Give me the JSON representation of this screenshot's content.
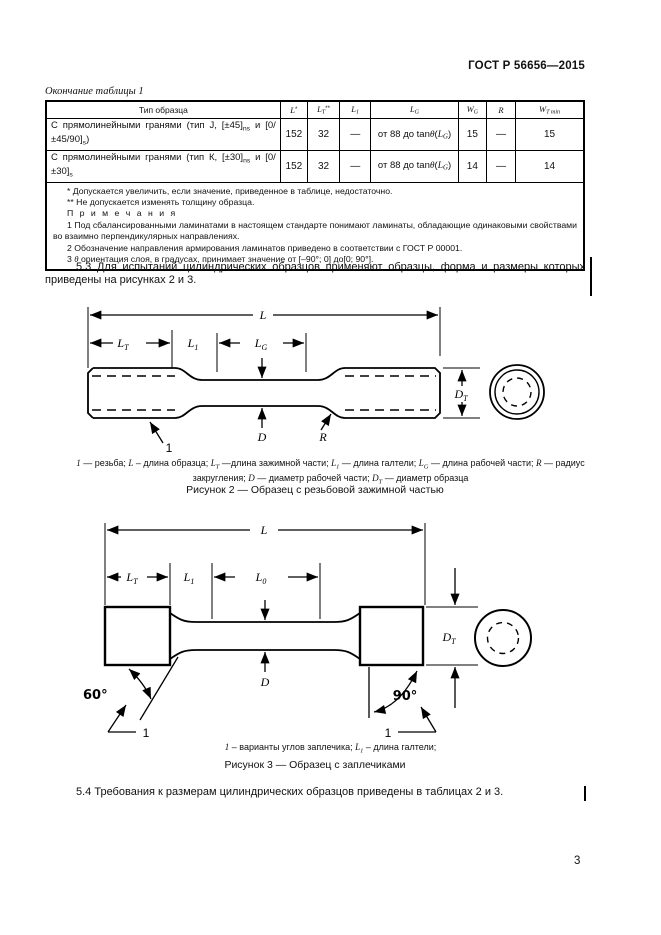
{
  "header": {
    "title": "ГОСТ Р 56656—2015"
  },
  "table_caption": "Окончание таблицы 1",
  "table": {
    "columns": [
      {
        "rich": [
          {
            "t": "Тип образца"
          }
        ]
      },
      {
        "rich": [
          {
            "t": "L",
            "s": "i"
          },
          {
            "t": "*",
            "s": "sup"
          }
        ]
      },
      {
        "rich": [
          {
            "t": "L",
            "s": "i"
          },
          {
            "t": "T",
            "s": "isub"
          },
          {
            "t": "**",
            "s": "sup"
          }
        ]
      },
      {
        "rich": [
          {
            "t": "L",
            "s": "i"
          },
          {
            "t": "1",
            "s": "isub"
          }
        ]
      },
      {
        "rich": [
          {
            "t": "L",
            "s": "i"
          },
          {
            "t": "G",
            "s": "isub"
          }
        ]
      },
      {
        "rich": [
          {
            "t": "W",
            "s": "i"
          },
          {
            "t": "G",
            "s": "isub"
          }
        ]
      },
      {
        "rich": [
          {
            "t": "R",
            "s": "i"
          }
        ]
      },
      {
        "rich": [
          {
            "t": "W",
            "s": "i"
          },
          {
            "t": "T min",
            "s": "isub"
          }
        ]
      }
    ],
    "rows": [
      {
        "name": [
          {
            "t": "С прямолинейными гранями (тип J, [±45]"
          },
          {
            "t": "ns",
            "s": "sub"
          },
          {
            "t": " и [0/±45/90]"
          },
          {
            "t": "s",
            "s": "sub"
          },
          {
            "t": ")"
          }
        ],
        "l": "152",
        "lt": "32",
        "l1": "—",
        "lg": [
          {
            "t": "от 88 до tan"
          },
          {
            "t": "θ",
            "s": "i"
          },
          {
            "t": "("
          },
          {
            "t": "L",
            "s": "i"
          },
          {
            "t": "G",
            "s": "isub"
          },
          {
            "t": ")"
          }
        ],
        "wg": "15",
        "r": "—",
        "wt": "15"
      },
      {
        "name": [
          {
            "t": "С прямолинейными гранями (тип К, [±30]"
          },
          {
            "t": "ns",
            "s": "sub"
          },
          {
            "t": " и [0/±30]"
          },
          {
            "t": "s",
            "s": "sub"
          },
          {
            "t": ""
          }
        ],
        "l": "152",
        "lt": "32",
        "l1": "—",
        "lg": [
          {
            "t": "от 88 до tan"
          },
          {
            "t": "θ",
            "s": "i"
          },
          {
            "t": "("
          },
          {
            "t": "L",
            "s": "i"
          },
          {
            "t": "G",
            "s": "isub"
          },
          {
            "t": ")"
          }
        ],
        "wg": "14",
        "r": "—",
        "wt": "14"
      }
    ],
    "footnotes": {
      "fn1": "* Допускается увеличить, если значение, приведенное в таблице, недостаточно.",
      "fn2": "** Не допускается изменять толщину образца.",
      "notes_title": "П р и м е ч а н и я",
      "note1": "1 Под сбалансированными ламинатами в настоящем стандарте понимают ламинаты, обладающие одинаковыми свойствами во взаимно перпендикулярных направлениях.",
      "note2": "2 Обозначение направления армирования ламинатов приведено в соответствии с ГОСТ Р 00001.",
      "note3": [
        {
          "t": "3 "
        },
        {
          "t": "θ",
          "s": "i"
        },
        {
          "t": " ориентация слоя, в градусах, принимает значение от [–90°; 0] до[0; 90°]."
        }
      ]
    }
  },
  "paragraphs": {
    "p53": "5.3 Для испытаний цилиндрических образцов применяют образцы, форма и размеры которых приведены на рисунках 2 и 3.",
    "p54": "5.4 Требования к размерам цилиндрических образцов приведены в таблицах 2 и 3."
  },
  "figure2": {
    "labels": {
      "l": "L",
      "lt_base": "L",
      "lt_sub": "T",
      "l1_base": "L",
      "l1_sub": "1",
      "lg_base": "L",
      "lg_sub": "G",
      "d": "D",
      "r": "R",
      "dt_base": "D",
      "dt_sub": "T",
      "callout": "1"
    },
    "caption": [
      {
        "t": "1",
        "s": "i"
      },
      {
        "t": " — резьба; "
      },
      {
        "t": "L",
        "s": "i"
      },
      {
        "t": " – длина образца; "
      },
      {
        "t": "L",
        "s": "i"
      },
      {
        "t": "T",
        "s": "isub"
      },
      {
        "t": " —длина зажимной части; "
      },
      {
        "t": "L",
        "s": "i"
      },
      {
        "t": "1",
        "s": "isub"
      },
      {
        "t": " — длина галтели; "
      },
      {
        "t": "L",
        "s": "i"
      },
      {
        "t": "G",
        "s": "isub"
      },
      {
        "t": " — длина рабочей части; "
      },
      {
        "t": "R",
        "s": "i"
      },
      {
        "t": " — радиус закругления; "
      },
      {
        "t": "D",
        "s": "i"
      },
      {
        "t": " — диаметр рабочей части; "
      },
      {
        "t": "D",
        "s": "i"
      },
      {
        "t": "T",
        "s": "isub"
      },
      {
        "t": " — диаметр образца"
      }
    ],
    "title": "Рисунок 2 — Образец с резьбовой зажимной частью"
  },
  "figure3": {
    "labels": {
      "l": "L",
      "lt_base": "L",
      "lt_sub": "T",
      "l1_base": "L",
      "l1_sub": "1",
      "l0_base": "L",
      "l0_sub": "0",
      "d": "D",
      "dt_base": "D",
      "dt_sub": "T",
      "angle_left": "60°",
      "angle_right": "90°",
      "callout_left": "1",
      "callout_right": "1"
    },
    "caption": [
      {
        "t": "1",
        "s": "i"
      },
      {
        "t": " – варианты углов заплечика; "
      },
      {
        "t": "L",
        "s": "i"
      },
      {
        "t": "1",
        "s": "isub"
      },
      {
        "t": " – длина галтели;"
      }
    ],
    "title": "Рисунок 3 — Образец с заплечиками"
  },
  "page_number": "3"
}
